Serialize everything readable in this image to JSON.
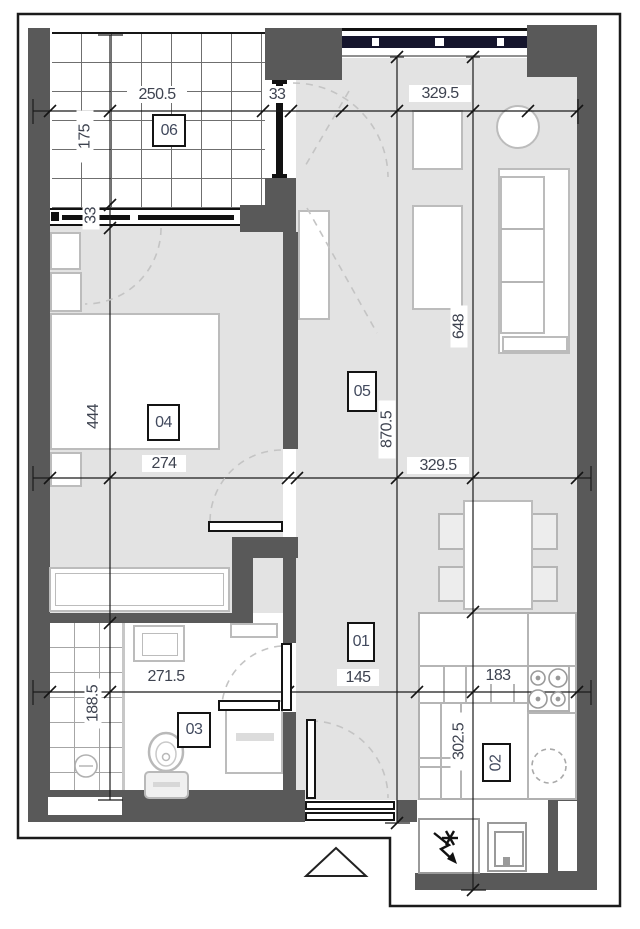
{
  "drawing": {
    "type": "apartment floor plan",
    "colors": {
      "wall": "#595959",
      "floor": "#e3e3e3",
      "outline": "#1b1b1b",
      "window_band": "#15152c",
      "furniture_line": "#bcbcbc"
    }
  },
  "rooms": {
    "hall": "01",
    "kitchen": "02",
    "bath": "03",
    "bedroom": "04",
    "living": "05",
    "balcony": "06"
  },
  "dims": {
    "balcony_width": "250.5",
    "balcony_window": "33",
    "living_top_width": "329.5",
    "balcony_depth": "175",
    "balcony_door": "33",
    "bedroom_depth": "444",
    "bedroom_width": "274",
    "living_mid_width": "329.5",
    "living_length": "870.5",
    "kitchen_wall_length": "648",
    "bath_width": "271.5",
    "bath_depth": "188.5",
    "hall_width": "145",
    "kitchen_width": "183",
    "kitchen_depth": "302.5"
  }
}
